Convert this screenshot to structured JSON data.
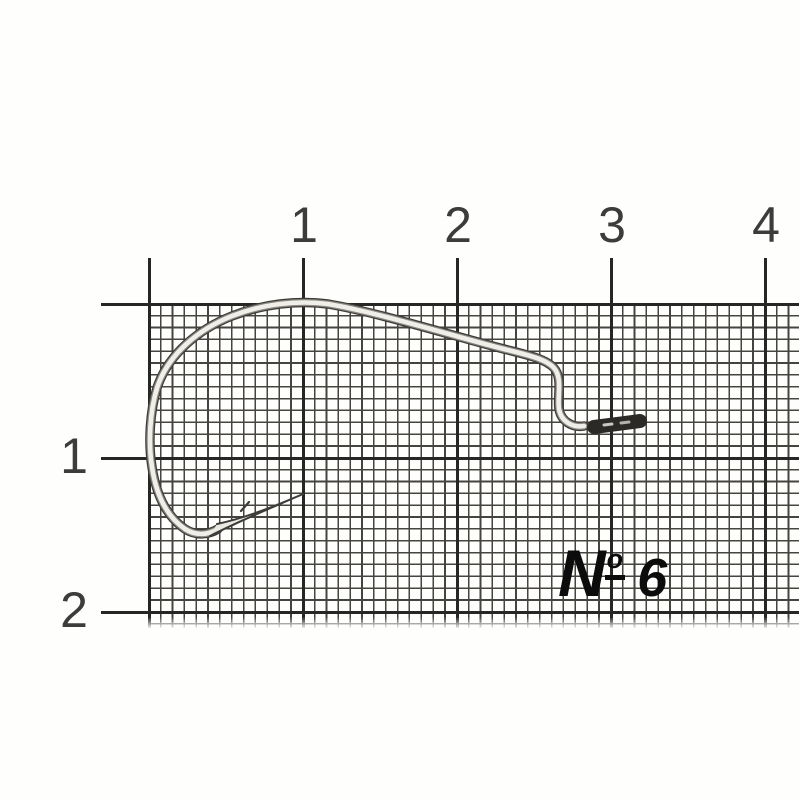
{
  "photo": {
    "subject": "fishing hook on millimeter graph paper",
    "background_color": "#fefefd"
  },
  "ruler": {
    "top_labels": [
      "1",
      "2",
      "3",
      "4"
    ],
    "left_labels": [
      "1",
      "2"
    ],
    "tick_color": "#262624"
  },
  "grid": {
    "minor_line_color": "#454440",
    "major_line_color": "#262624"
  },
  "size_label": {
    "text": "№ 6",
    "numero_letter": "N",
    "numero_ordinal": "o",
    "size_value": "6"
  },
  "hook": {
    "type": "offset worm hook",
    "outline_color": "#3d3c38",
    "mid_color": "#8a8880",
    "wire_color": "#f0eee8",
    "point_fill": "#eae8e1",
    "eye_color": "#2b2a27",
    "glint_color": "#c9c7c0",
    "glint_color_2": "#b4b2ab"
  }
}
